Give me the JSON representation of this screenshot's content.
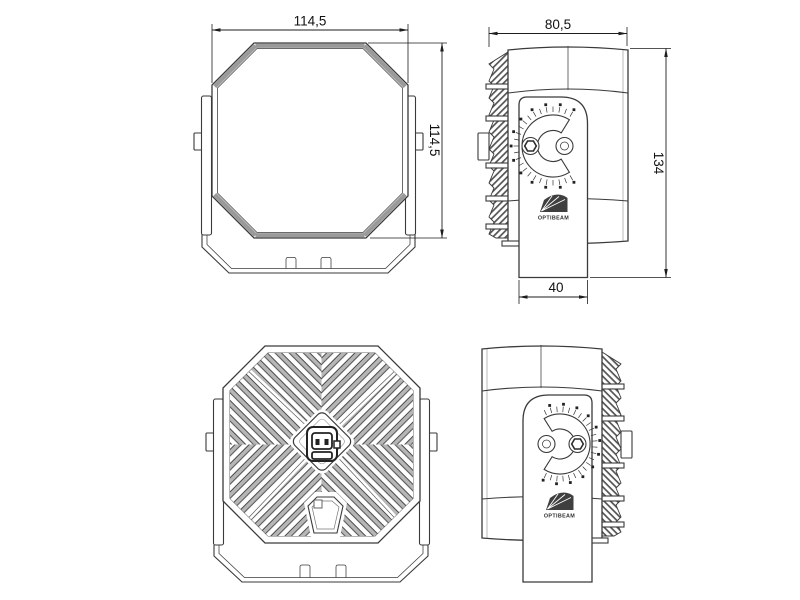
{
  "drawing": {
    "brand": "OPTIBEAM",
    "dimensions": {
      "front_width": "114,5",
      "front_height": "114,5",
      "side_depth": "80,5",
      "side_height": "134",
      "bracket_width": "40"
    },
    "colors": {
      "line": "#3a3a3a",
      "shade": "#9a9a9a",
      "background": "#ffffff"
    }
  }
}
